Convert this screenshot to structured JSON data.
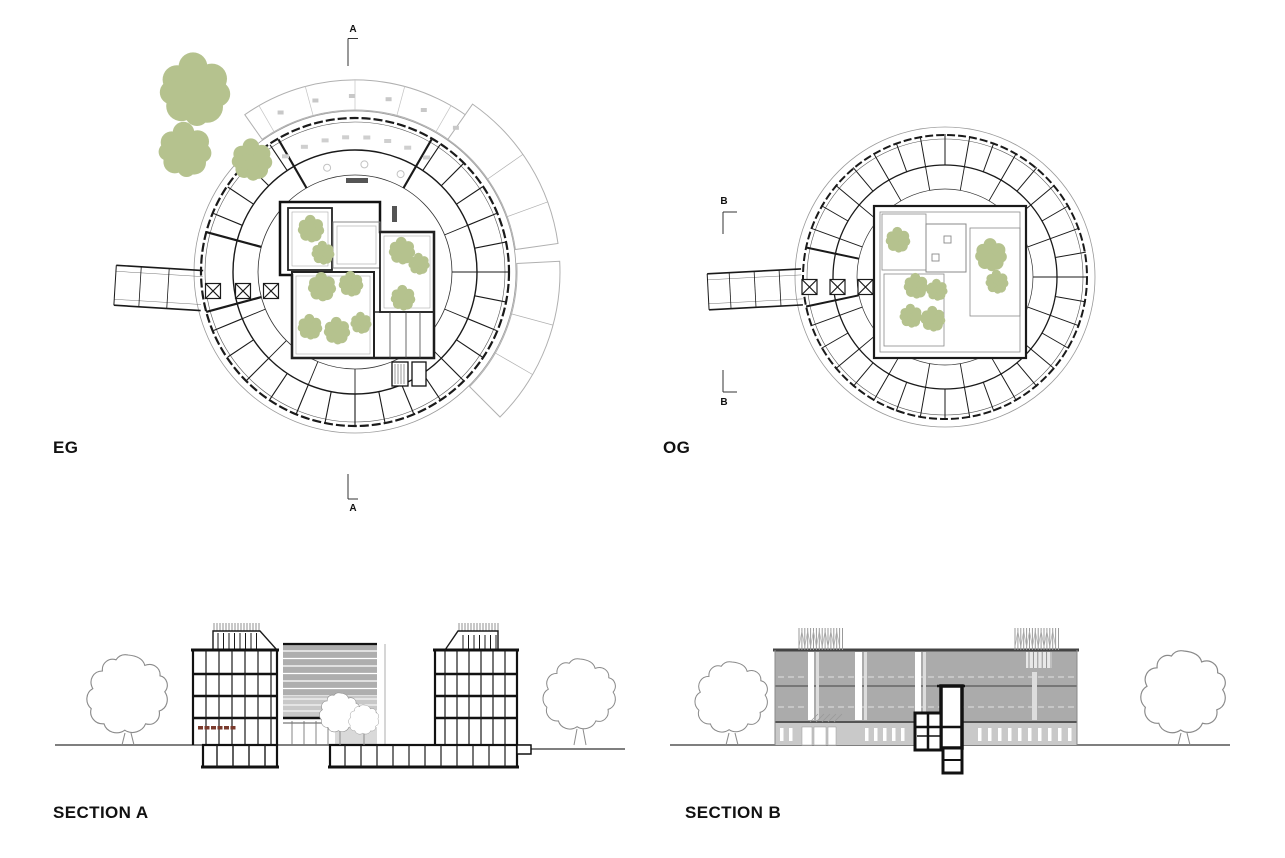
{
  "sheet": {
    "plans": [
      {
        "id": "eg",
        "label": "EG",
        "marker_letter": "A"
      },
      {
        "id": "og",
        "label": "OG",
        "marker_letter": "B"
      }
    ],
    "sections": [
      {
        "id": "section-a",
        "label": "SECTION A"
      },
      {
        "id": "section-b",
        "label": "SECTION B"
      }
    ]
  },
  "markers": {
    "a": "A",
    "b": "B"
  },
  "colors": {
    "tree_green": "#b5c28e",
    "outline_gray": "#8a8a8a",
    "facade_gray": "#ababab",
    "plinth_gray": "#c9c9c9",
    "atrium_gray": "#aeaeae",
    "light_gray": "#c8c8c8",
    "line_black": "#1a1a1a",
    "accent_dark_red": "#7a3a2c"
  }
}
